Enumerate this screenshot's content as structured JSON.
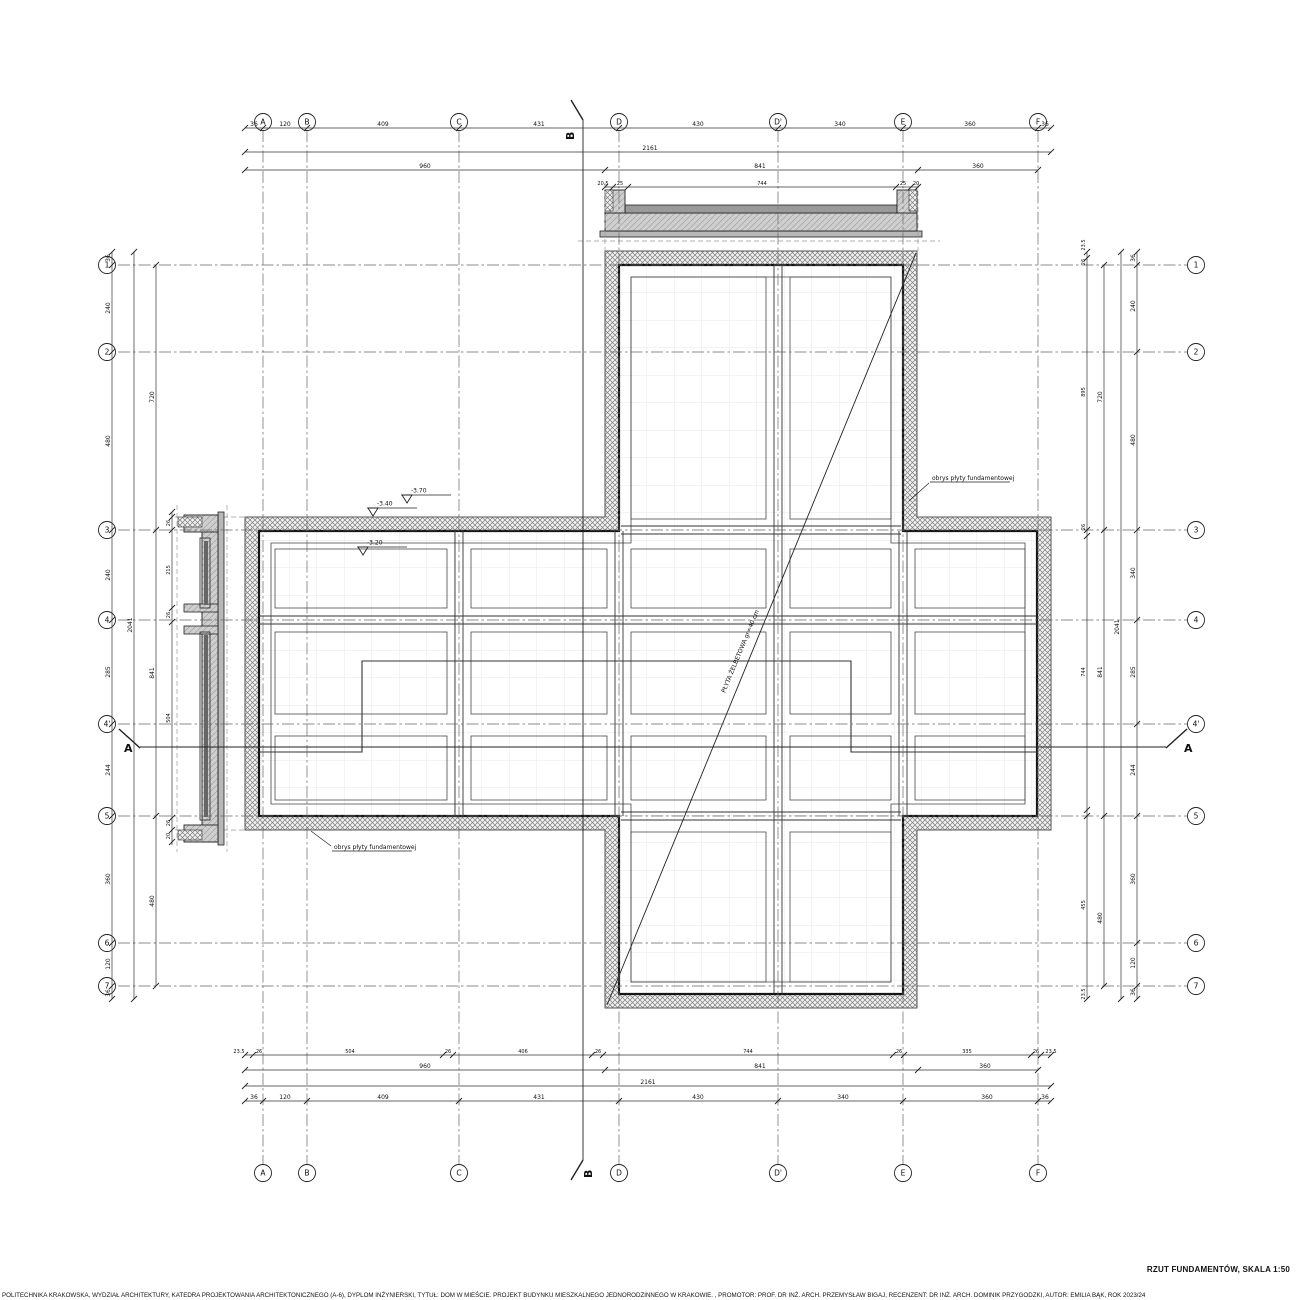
{
  "title": "RZUT FUNDAMENTÓW, SKALA 1:50",
  "footer": "POLITECHNIKA KRAKOWSKA, WYDZIAŁ ARCHITEKTURY, KATEDRA PROJEKTOWANIA ARCHITEKTONICZNEGO (A-6), DYPLOM INŻYNIERSKI, TYTUŁ: DOM W MIEŚCIE. PROJEKT BUDYNKU MIESZKALNEGO JEDNORODZINNEGO W KRAKOWIE. , PROMOTOR: PROF. DR INŻ. ARCH. PRZEMYSŁAW BIGAJ, RECENZENT: DR INŻ. ARCH. DOMINIK PRZYGODZKI, AUTOR: EMILIA BĄK, ROK 2023/24",
  "colors": {
    "line": "#1a1a1a",
    "mid": "#444444",
    "light": "#888888",
    "mesh": "#e7e7e7",
    "concrete": "#cfcfcf",
    "plate": "#b8b8b8",
    "screed": "#9a9a9a"
  },
  "axes": {
    "vertical": [
      {
        "label": "A",
        "x": 263
      },
      {
        "label": "B",
        "x": 307
      },
      {
        "label": "C",
        "x": 459
      },
      {
        "label": "D",
        "x": 619
      },
      {
        "label": "D'",
        "x": 778
      },
      {
        "label": "E",
        "x": 903
      },
      {
        "label": "F",
        "x": 1038
      }
    ],
    "horizontal": [
      {
        "label": "1",
        "y": 265
      },
      {
        "label": "2",
        "y": 352
      },
      {
        "label": "3",
        "y": 530
      },
      {
        "label": "4",
        "y": 620
      },
      {
        "label": "4'",
        "y": 724
      },
      {
        "label": "5",
        "y": 816
      },
      {
        "label": "6",
        "y": 943
      },
      {
        "label": "7",
        "y": 986
      }
    ]
  },
  "section_markers": {
    "a_label": "A",
    "b_label": "B"
  },
  "annotations": {
    "diagonal_text": "PŁYTA ŻELBETOWA gr=40 cm",
    "levels": [
      {
        "value": "-3.70",
        "x": 407,
        "y": 503
      },
      {
        "value": "-3.40",
        "x": 373,
        "y": 516
      },
      {
        "value": "-3.20",
        "x": 363,
        "y": 555
      }
    ],
    "leaders": [
      {
        "text": "obrys płyty fundamentowej",
        "tx": 932,
        "ty": 480,
        "x1": 929,
        "y1": 483,
        "x2": 909,
        "y2": 501
      },
      {
        "text": "obrys płyty fundamentowej",
        "tx": 334,
        "ty": 849,
        "x1": 331,
        "y1": 846,
        "x2": 311,
        "y2": 831
      }
    ]
  },
  "dimensions": [
    {
      "id": "top1",
      "o": "h",
      "pos": 128,
      "a": 245,
      "b": 1051,
      "ticks": [
        245,
        263,
        307,
        459,
        619,
        778,
        903,
        1038,
        1051
      ],
      "labels": [
        {
          "at": 254,
          "v": "36"
        },
        {
          "at": 285,
          "v": "120"
        },
        {
          "at": 383,
          "v": "409"
        },
        {
          "at": 539,
          "v": "431"
        },
        {
          "at": 698,
          "v": "430"
        },
        {
          "at": 840,
          "v": "340"
        },
        {
          "at": 970,
          "v": "360"
        },
        {
          "at": 1045,
          "v": "36"
        }
      ]
    },
    {
      "id": "top2",
      "o": "h",
      "pos": 152,
      "a": 245,
      "b": 1051,
      "ticks": [
        245,
        1051
      ],
      "labels": [
        {
          "at": 650,
          "v": "2161"
        }
      ]
    },
    {
      "id": "top3",
      "o": "h",
      "pos": 170,
      "a": 245,
      "b": 1038,
      "ticks": [
        245,
        605,
        918,
        1038
      ],
      "labels": [
        {
          "at": 425,
          "v": "960"
        },
        {
          "at": 760,
          "v": "841"
        },
        {
          "at": 978,
          "v": "360"
        }
      ]
    },
    {
      "id": "top4",
      "o": "h",
      "pos": 187,
      "a": 605,
      "b": 918,
      "small": true,
      "ticks": [
        605,
        613,
        628,
        896,
        911,
        918
      ],
      "labels": [
        {
          "at": 603,
          "v": "20.5"
        },
        {
          "at": 620,
          "v": "25"
        },
        {
          "at": 762,
          "v": "744"
        },
        {
          "at": 903,
          "v": "25"
        },
        {
          "at": 916,
          "v": "20"
        }
      ]
    },
    {
      "id": "bot1",
      "o": "h",
      "pos": 1055,
      "a": 245,
      "b": 1051,
      "small": true,
      "ticks": [
        245,
        253,
        443,
        453,
        592,
        603,
        893,
        904,
        1031,
        1041,
        1051
      ],
      "labels": [
        {
          "at": 239,
          "v": "23.5"
        },
        {
          "at": 259,
          "v": "26"
        },
        {
          "at": 350,
          "v": "504"
        },
        {
          "at": 448,
          "v": "26"
        },
        {
          "at": 523,
          "v": "406"
        },
        {
          "at": 598,
          "v": "26"
        },
        {
          "at": 748,
          "v": "744"
        },
        {
          "at": 899,
          "v": "26"
        },
        {
          "at": 967,
          "v": "335"
        },
        {
          "at": 1036,
          "v": "26"
        },
        {
          "at": 1051,
          "v": "23.5"
        }
      ]
    },
    {
      "id": "bot2",
      "o": "h",
      "pos": 1070,
      "a": 245,
      "b": 1038,
      "ticks": [
        245,
        605,
        918,
        1038
      ],
      "labels": [
        {
          "at": 425,
          "v": "960"
        },
        {
          "at": 760,
          "v": "841"
        },
        {
          "at": 985,
          "v": "360"
        }
      ]
    },
    {
      "id": "bot3",
      "o": "h",
      "pos": 1086,
      "a": 245,
      "b": 1051,
      "ticks": [
        245,
        1051
      ],
      "labels": [
        {
          "at": 648,
          "v": "2161"
        }
      ]
    },
    {
      "id": "bot4",
      "o": "h",
      "pos": 1101,
      "a": 245,
      "b": 1051,
      "ticks": [
        245,
        263,
        307,
        459,
        619,
        778,
        903,
        1038,
        1051
      ],
      "labels": [
        {
          "at": 254,
          "v": "36"
        },
        {
          "at": 285,
          "v": "120"
        },
        {
          "at": 383,
          "v": "409"
        },
        {
          "at": 539,
          "v": "431"
        },
        {
          "at": 698,
          "v": "430"
        },
        {
          "at": 843,
          "v": "340"
        },
        {
          "at": 987,
          "v": "360"
        },
        {
          "at": 1045,
          "v": "36"
        }
      ]
    },
    {
      "id": "left1",
      "o": "v",
      "pos": 112,
      "a": 252,
      "b": 999,
      "ticks": [
        252,
        265,
        352,
        530,
        620,
        724,
        816,
        943,
        986,
        999
      ],
      "labels": [
        {
          "at": 258,
          "v": "36"
        },
        {
          "at": 308,
          "v": "240"
        },
        {
          "at": 441,
          "v": "480"
        },
        {
          "at": 575,
          "v": "240"
        },
        {
          "at": 672,
          "v": "285"
        },
        {
          "at": 770,
          "v": "244"
        },
        {
          "at": 879,
          "v": "360"
        },
        {
          "at": 964,
          "v": "120"
        },
        {
          "at": 993,
          "v": "36"
        }
      ]
    },
    {
      "id": "left2",
      "o": "v",
      "pos": 134,
      "a": 252,
      "b": 999,
      "ticks": [
        252,
        999
      ],
      "labels": [
        {
          "at": 625,
          "v": "2041"
        }
      ]
    },
    {
      "id": "left3",
      "o": "v",
      "pos": 156,
      "a": 265,
      "b": 986,
      "ticks": [
        265,
        530,
        816,
        986
      ],
      "labels": [
        {
          "at": 397,
          "v": "720"
        },
        {
          "at": 673,
          "v": "841"
        },
        {
          "at": 901,
          "v": "480"
        }
      ]
    },
    {
      "id": "leftd",
      "o": "v",
      "pos": 172,
      "a": 512,
      "b": 845,
      "small": true,
      "ticks": [
        512,
        517,
        530,
        608,
        622,
        818,
        830,
        842
      ],
      "labels": [
        {
          "at": 523,
          "v": "26"
        },
        {
          "at": 570,
          "v": "215"
        },
        {
          "at": 615,
          "v": "26"
        },
        {
          "at": 718,
          "v": "504"
        },
        {
          "at": 823,
          "v": "26"
        },
        {
          "at": 836,
          "v": "20"
        }
      ]
    },
    {
      "id": "right1",
      "o": "v",
      "pos": 1087,
      "a": 252,
      "b": 999,
      "small": true,
      "ticks": [
        252,
        258,
        530,
        536,
        810,
        816,
        999
      ],
      "labels": [
        {
          "at": 245,
          "v": "23.5"
        },
        {
          "at": 262,
          "v": "26"
        },
        {
          "at": 392,
          "v": "895"
        },
        {
          "at": 527,
          "v": "26"
        },
        {
          "at": 672,
          "v": "744"
        },
        {
          "at": 905,
          "v": "455"
        },
        {
          "at": 994,
          "v": "23.5"
        }
      ]
    },
    {
      "id": "right2",
      "o": "v",
      "pos": 1104,
      "a": 265,
      "b": 986,
      "ticks": [
        265,
        530,
        816,
        986
      ],
      "labels": [
        {
          "at": 397,
          "v": "720"
        },
        {
          "at": 672,
          "v": "841"
        },
        {
          "at": 918,
          "v": "480"
        }
      ]
    },
    {
      "id": "right3",
      "o": "v",
      "pos": 1121,
      "a": 252,
      "b": 999,
      "ticks": [
        252,
        999
      ],
      "labels": [
        {
          "at": 627,
          "v": "2041"
        }
      ]
    },
    {
      "id": "right4",
      "o": "v",
      "pos": 1137,
      "a": 252,
      "b": 999,
      "ticks": [
        252,
        265,
        352,
        530,
        620,
        724,
        816,
        943,
        986,
        999
      ],
      "labels": [
        {
          "at": 258,
          "v": "36"
        },
        {
          "at": 306,
          "v": "240"
        },
        {
          "at": 440,
          "v": "480"
        },
        {
          "at": 573,
          "v": "340"
        },
        {
          "at": 672,
          "v": "285"
        },
        {
          "at": 770,
          "v": "244"
        },
        {
          "at": 879,
          "v": "360"
        },
        {
          "at": 963,
          "v": "120"
        },
        {
          "at": 992,
          "v": "36"
        }
      ]
    }
  ]
}
